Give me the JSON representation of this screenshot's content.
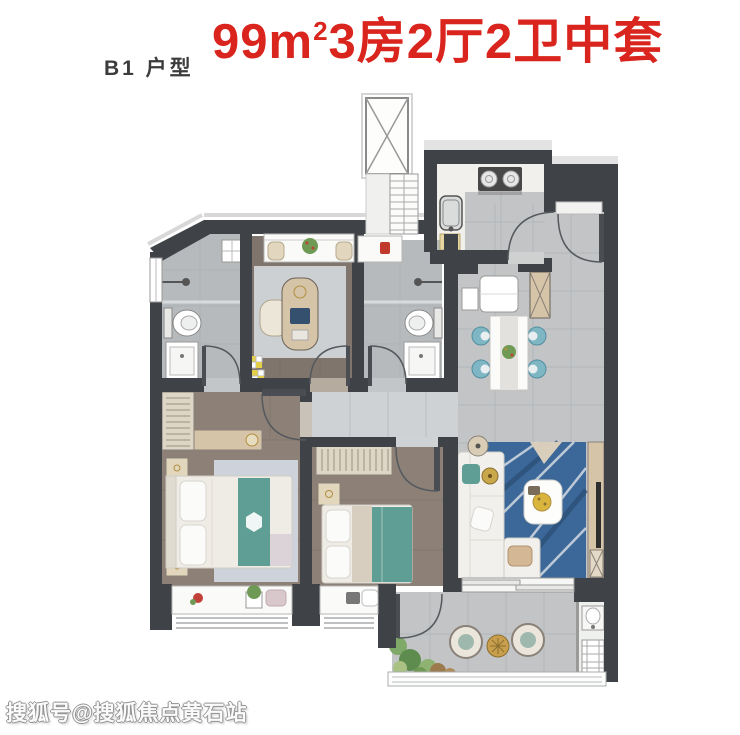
{
  "header": {
    "unit_label": "B1 户型",
    "title": {
      "pre": "99m",
      "sup": "2",
      "post": "3房2厅2卫中套"
    }
  },
  "watermark": {
    "text": "搜狐号@搜狐焦点黄石站"
  },
  "colors": {
    "title_red": "#d9251d",
    "watermark_gray": "#909090",
    "wall": "#3f4347",
    "wood": "#8c8077",
    "wood_study": "#7f756c",
    "tile": "#c2c4c6",
    "tile_light": "#ced2d4",
    "bath": "#b7babc",
    "white_surface": "#f1f0ed",
    "beige": "#d6c4a8",
    "teal": "#5f9e94",
    "rug_blue": "#3c6899",
    "chair_teal": "#7fb6c4",
    "plant_green": "#6f9a55"
  }
}
